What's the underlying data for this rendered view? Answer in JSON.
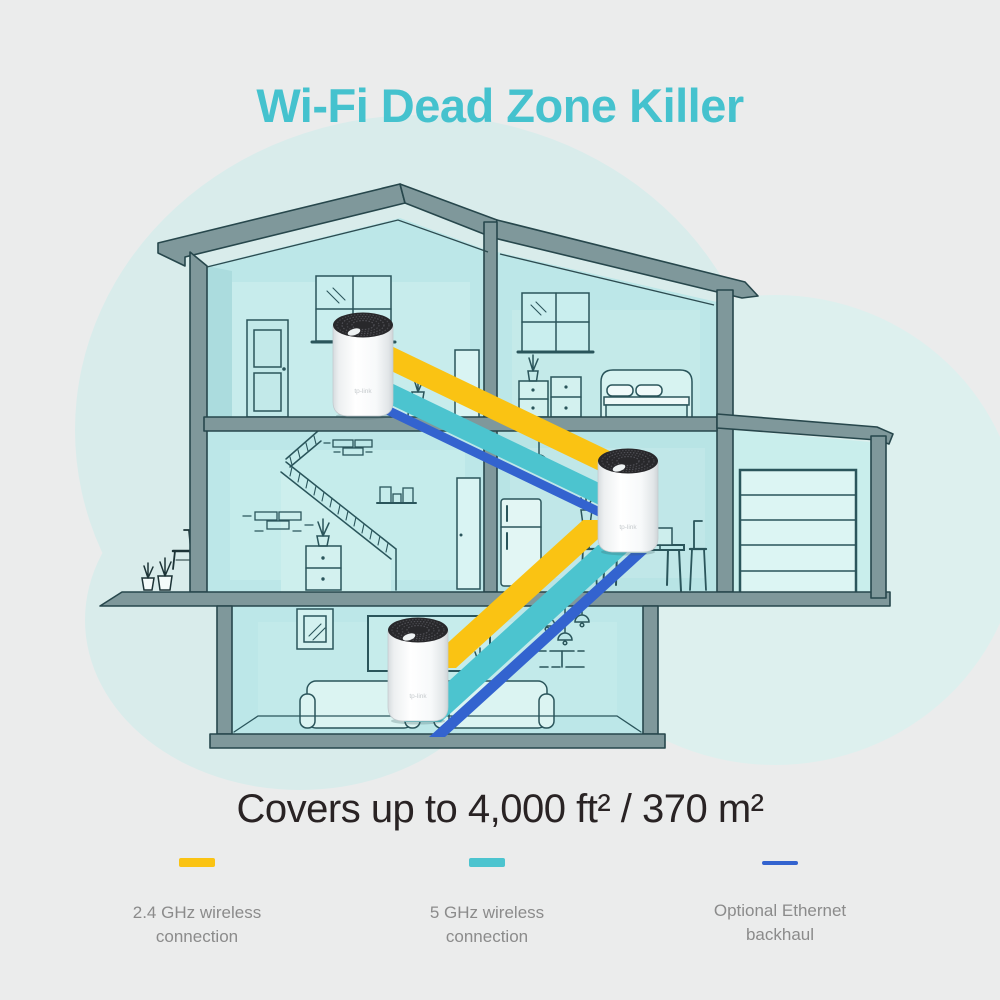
{
  "page": {
    "background_color": "#ebecec"
  },
  "header": {
    "title": "Wi-Fi Dead Zone Killer",
    "title_color": "#45c2ce"
  },
  "coverage": {
    "text": "Covers up to 4,000 ft² / 370 m²",
    "text_color": "#292324"
  },
  "legend": {
    "label_color": "#8b8b8b",
    "items": [
      {
        "id": "wireless-2-4ghz",
        "label": "2.4 GHz wireless connection",
        "color": "#fac313",
        "swatch_thickness": "thick"
      },
      {
        "id": "wireless-5ghz",
        "label": "5 GHz wireless connection",
        "color": "#4cc4cf",
        "swatch_thickness": "thick"
      },
      {
        "id": "ethernet-backhaul",
        "label": "Optional Ethernet backhaul",
        "color": "#3363cf",
        "swatch_thickness": "thin"
      }
    ]
  },
  "illustration": {
    "type": "house-cross-section",
    "floors": [
      "top floor",
      "middle floor with garage",
      "basement"
    ],
    "unit_logo": "tp-link",
    "units": [
      {
        "name": "mesh-unit-top-floor"
      },
      {
        "name": "mesh-unit-middle-floor"
      },
      {
        "name": "mesh-unit-basement"
      }
    ],
    "bands": {
      "wireless_2_4ghz_color": "#fac313",
      "wireless_5ghz_color": "#4cc4cf",
      "ethernet_color": "#3363cf"
    }
  }
}
